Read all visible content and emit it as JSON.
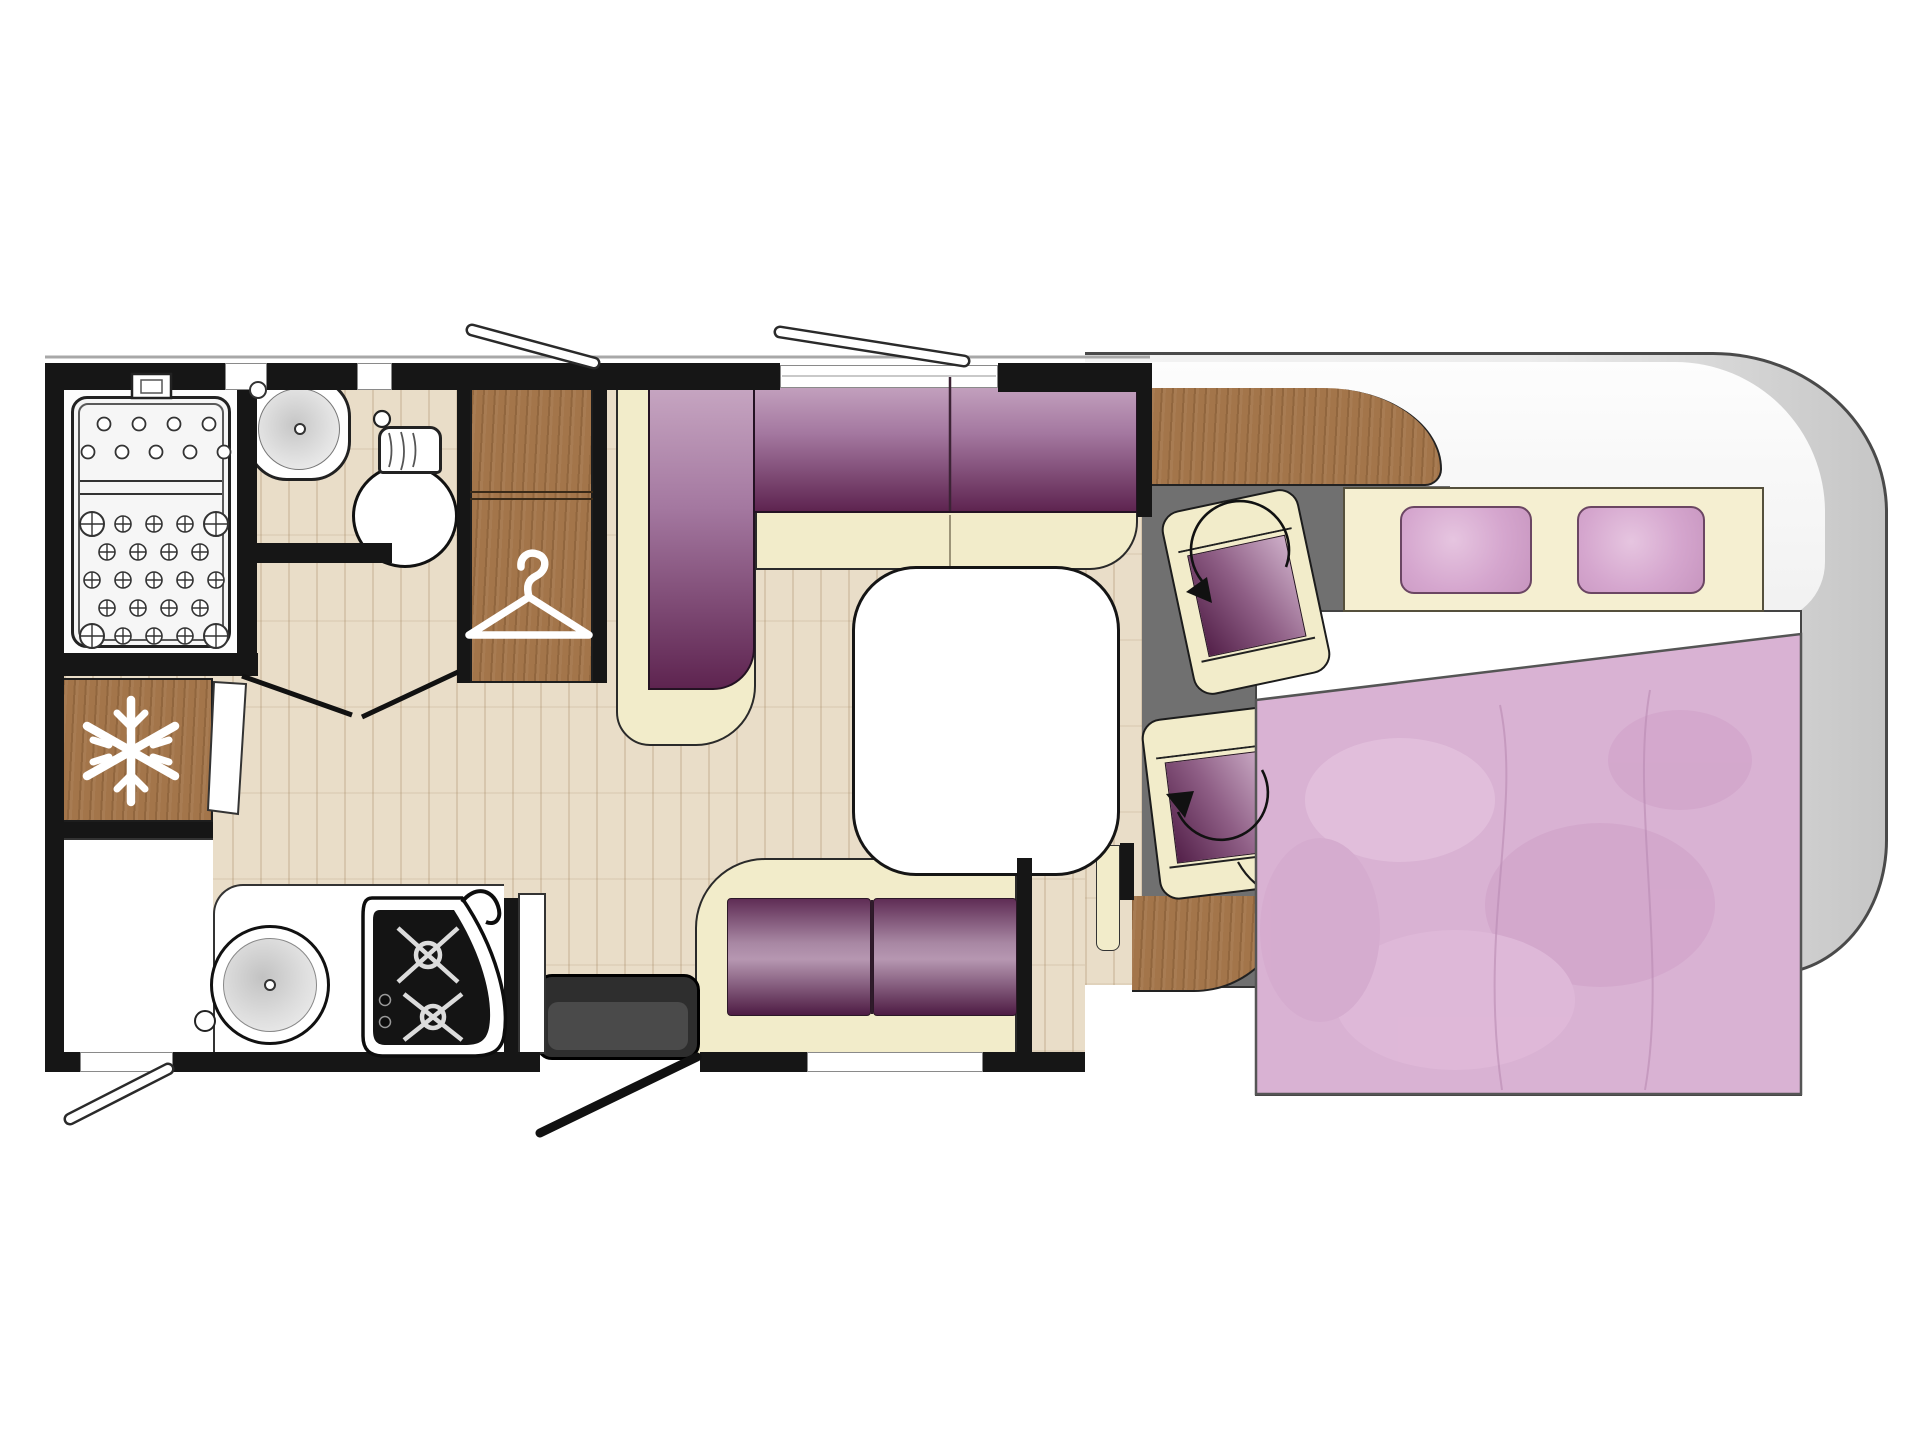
{
  "diagram": {
    "type": "motorhome-floor-plan",
    "view": "top-down plan, habitation on left, driver cab at right",
    "areas": [
      {
        "id": "shower",
        "desc": "shower cubicle with drain tray"
      },
      {
        "id": "bathroom",
        "desc": "washroom with basin and toilet"
      },
      {
        "id": "fridge",
        "desc": "refrigerator cabinet",
        "icon": "snowflake-icon"
      },
      {
        "id": "wardrobe",
        "desc": "wardrobe cabinet",
        "icon": "hanger-icon"
      },
      {
        "id": "dinette",
        "desc": "L-shaped lounge seating with table"
      },
      {
        "id": "bench",
        "desc": "side bench seat"
      },
      {
        "id": "kitchen",
        "desc": "kitchen block with sink and 3-burner hob"
      },
      {
        "id": "entry",
        "desc": "entrance door with step"
      },
      {
        "id": "cab",
        "desc": "driver cab with two swivel seats",
        "icon": "swivel-arrow-icon"
      },
      {
        "id": "bed",
        "desc": "double bed with two pillows and duvet"
      }
    ],
    "icons": [
      {
        "name": "snowflake-icon",
        "meaning": "refrigerator"
      },
      {
        "name": "hanger-icon",
        "meaning": "wardrobe"
      },
      {
        "name": "swivel-arrow-icon",
        "meaning": "rotating cab seat"
      }
    ],
    "colors": {
      "wall": "#161616",
      "upholstery_purple_dark": "#5e2450",
      "upholstery_purple_light": "#c9a9c4",
      "cream": "#f2ecca",
      "wood": "#a3754a",
      "floor_beige": "#e9ddc8",
      "cab_floor_gray": "#707070",
      "bed_pink": "#d9b2d3",
      "pillow_pink": "#d5a6ce",
      "shell_gray": "#d9d9d9"
    }
  }
}
